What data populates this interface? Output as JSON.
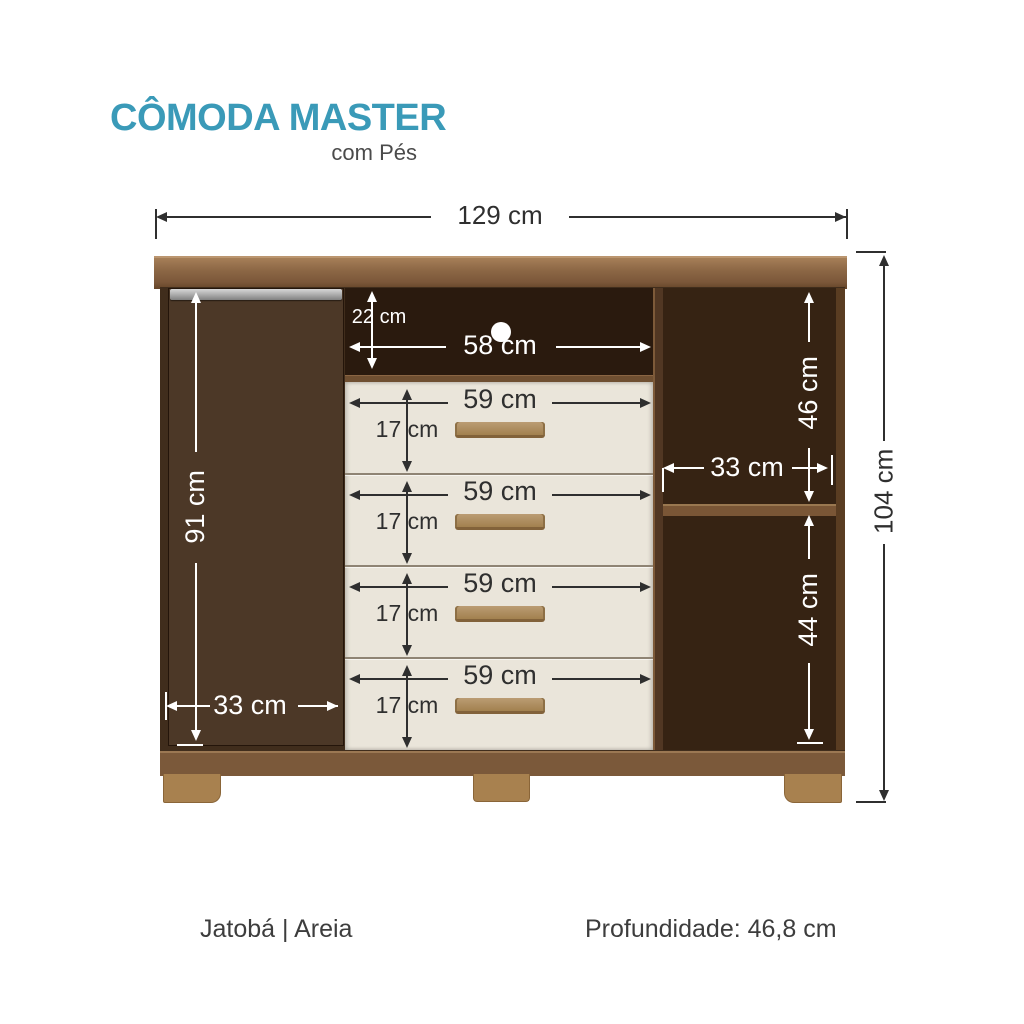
{
  "title": "CÔMODA MASTER",
  "subtitle": "com Pés",
  "dimensions": {
    "total_width": "129 cm",
    "total_height": "104 cm",
    "door_height": "91 cm",
    "door_width": "33 cm",
    "niche_height": "22 cm",
    "niche_width": "58 cm",
    "right_upper_height": "46 cm",
    "right_shelf_width": "33 cm",
    "right_lower_height": "44 cm"
  },
  "drawers": [
    {
      "width": "59 cm",
      "height": "17 cm"
    },
    {
      "width": "59 cm",
      "height": "17 cm"
    },
    {
      "width": "59 cm",
      "height": "17 cm"
    },
    {
      "width": "59 cm",
      "height": "17 cm"
    }
  ],
  "footer": {
    "finish": "Jatobá | Areia",
    "depth": "Profundidade: 46,8 cm"
  },
  "colors": {
    "accent_teal": "#3a9ab8",
    "wood_body_dark": "#402d1c",
    "wood_door": "#4c3827",
    "wood_crown": "#8c6745",
    "wood_base": "#7b593a",
    "wood_feet": "#a8814f",
    "drawer_front": "#eae5da",
    "drawer_handle": "#a2814f",
    "dimension_dark": "#2f2f2f",
    "dimension_light": "#ffffff"
  }
}
